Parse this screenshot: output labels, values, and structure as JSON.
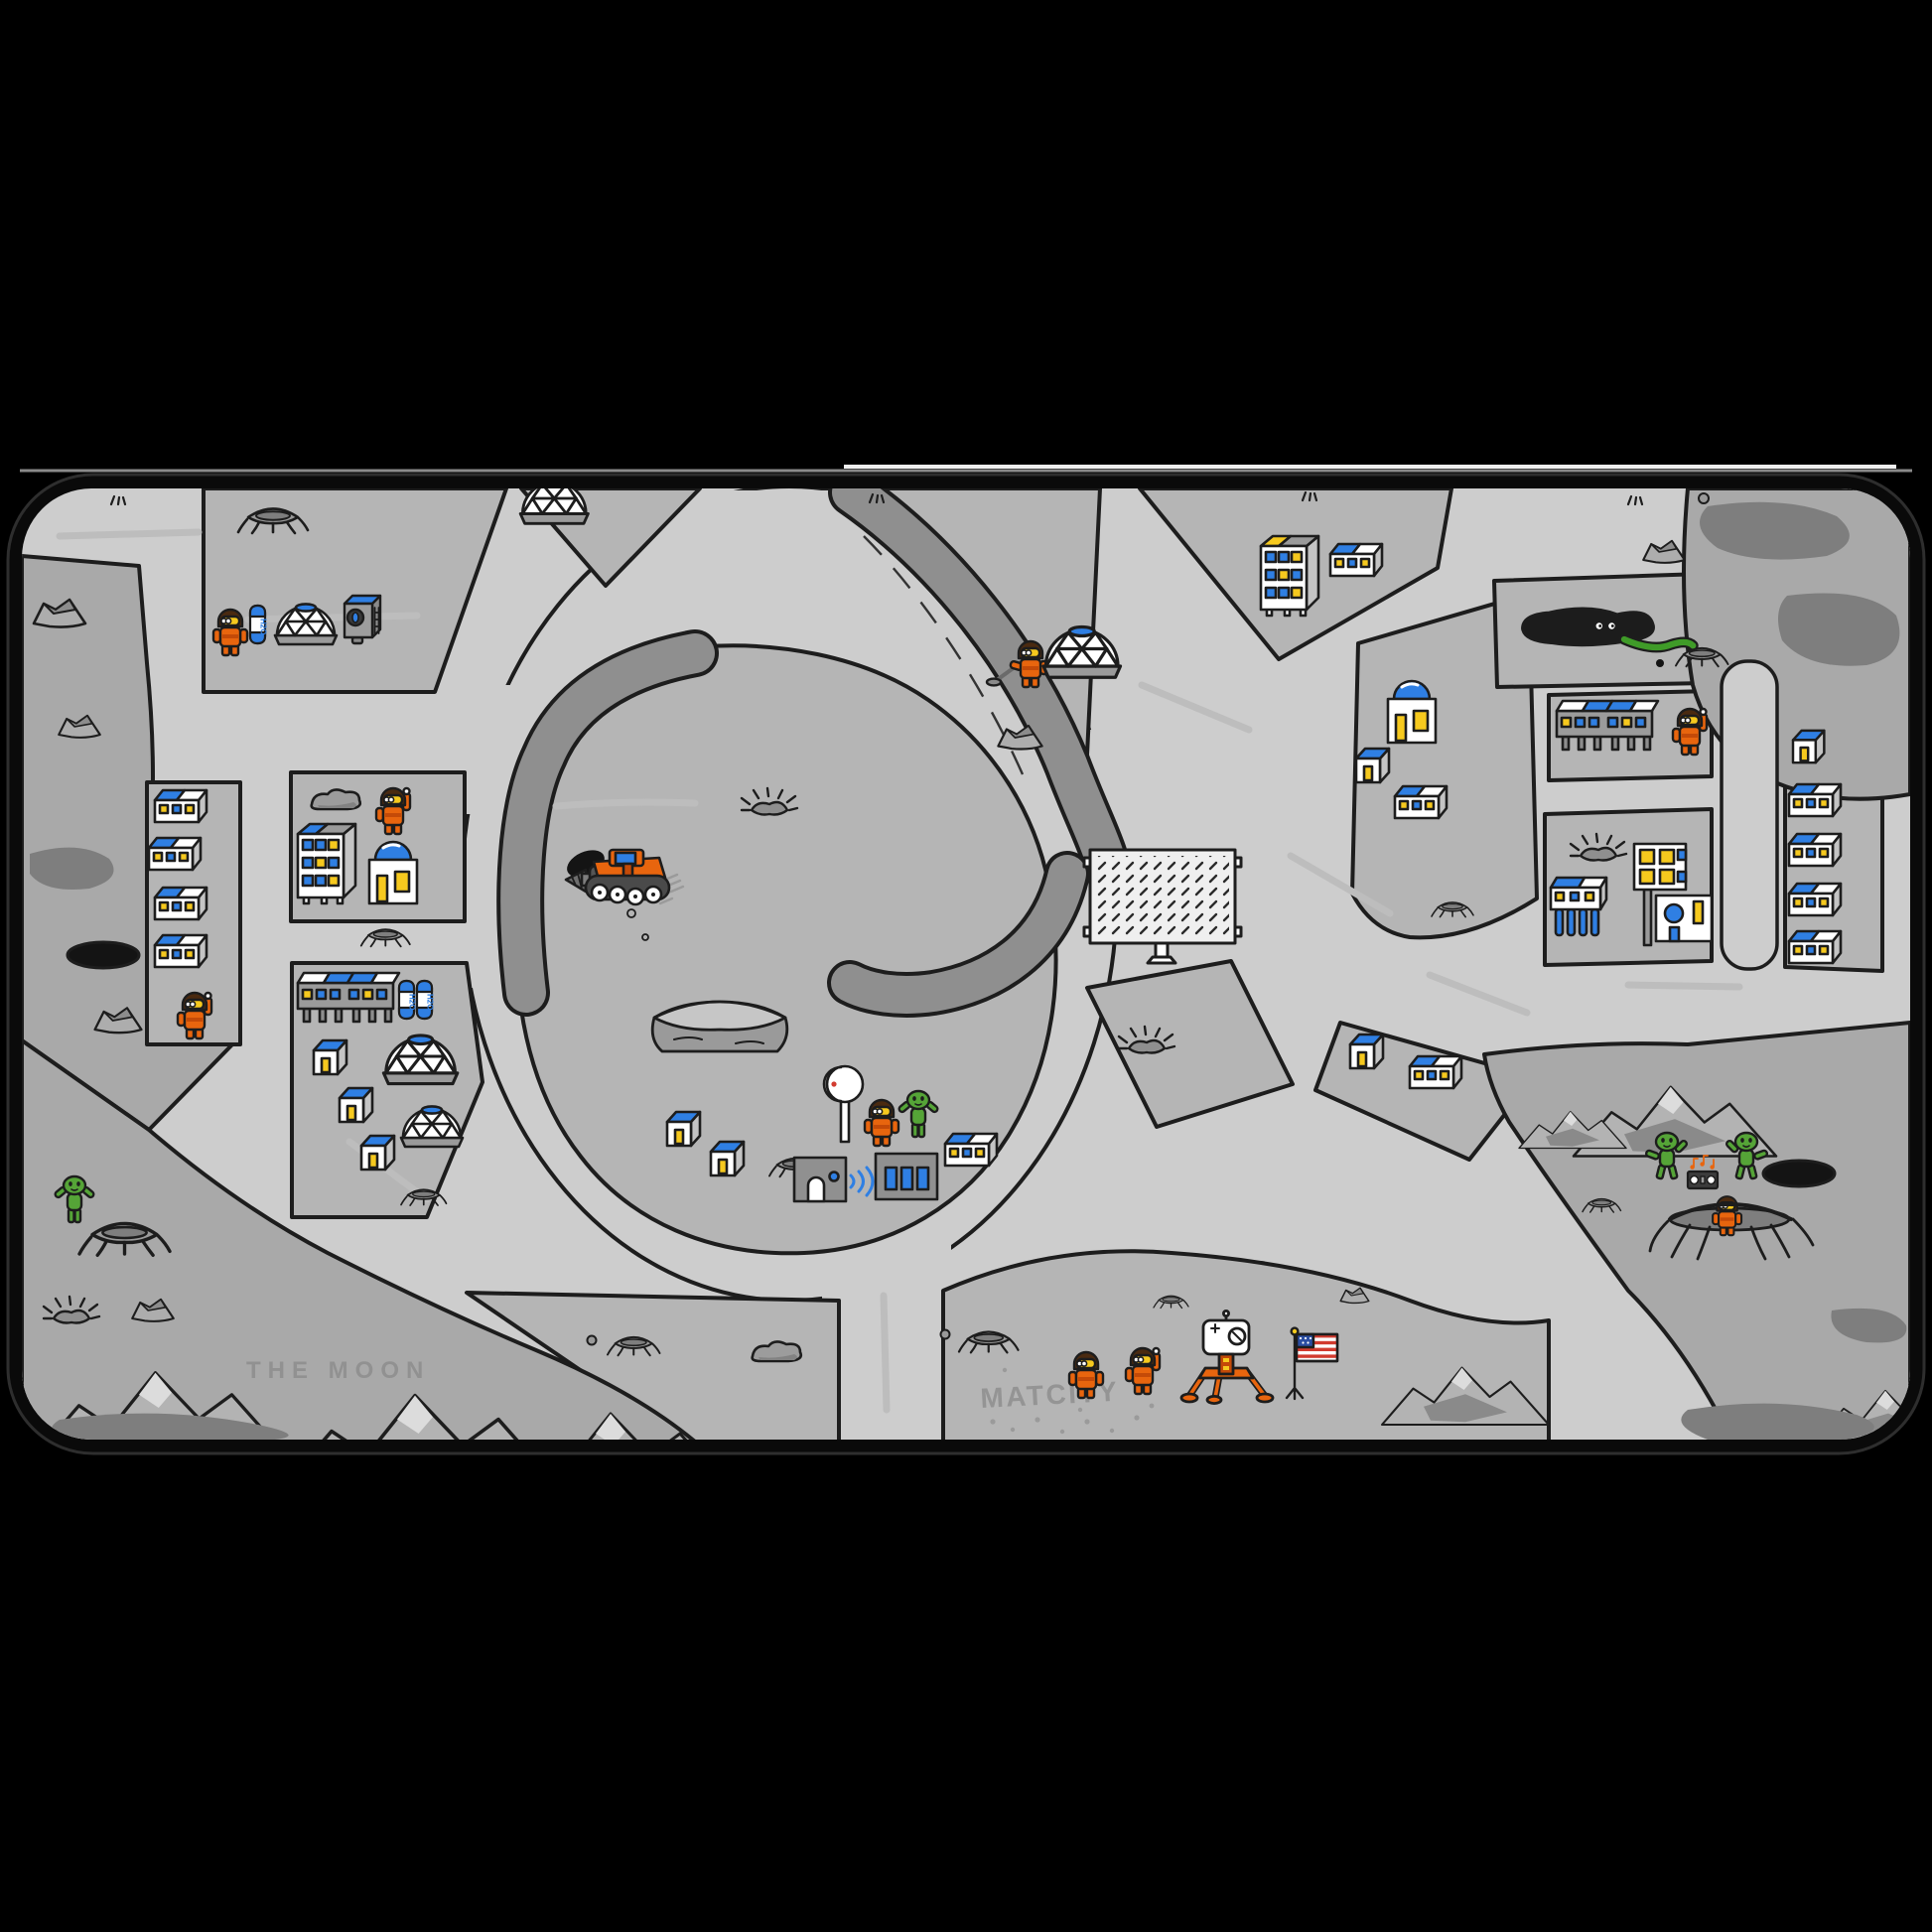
{
  "meta": {
    "description": "Product image of a moon-themed city play desk mat on a black backdrop",
    "surface": "THE MOON play mat with roads, craters, moon base buildings, astronauts and aliens"
  },
  "labels": {
    "region_name": "THE MOON",
    "city_name": "MATCITY",
    "tank_label": "H2O"
  },
  "colors": {
    "backdrop": "#000000",
    "mat_border": "#0a0a0a",
    "road": "#cdcdcd",
    "terrain": "#b5b5b5",
    "rocky_terrain": "#a9a9a9",
    "canyon": "#8f8f8f",
    "dark_patch": "#7e7e7e",
    "outline": "#1d1d1d",
    "accent_orange": "#e8650e",
    "accent_orange_dark": "#c44a08",
    "accent_blue": "#2f7fe3",
    "accent_yellow": "#f6c91e",
    "alien_green": "#55a437",
    "hole_black": "#141414",
    "flag_red": "#d23b2f",
    "flag_navy": "#2b4ea2",
    "white": "#ffffff"
  },
  "inventory": {
    "astronauts": 9,
    "aliens": 4,
    "geodesic_domes": 5,
    "observatory_buildings": 2,
    "apartment_buildings": 2,
    "houses": 8,
    "barracks_buildings": 12,
    "stilt_buildings": 3,
    "water_tanks": 3,
    "drill_vehicles": 1,
    "lunar_landers": 1,
    "us_flags": 1,
    "solar_panels": 1,
    "satellite_dishes": 1,
    "factories": 1,
    "space_snakes": 1,
    "boomboxes": 1
  },
  "zones": [
    {
      "name": "northwest-base",
      "features": [
        "astronaut",
        "H2O tank",
        "geodesic dome",
        "air machine",
        "craters"
      ]
    },
    {
      "name": "north-dome-island",
      "features": [
        "geodesic dome"
      ]
    },
    {
      "name": "central-crater-ring",
      "features": [
        "drill vehicle",
        "mesa",
        "satellite dish",
        "factory",
        "houses",
        "astronaut",
        "alien",
        "canyon rims"
      ]
    },
    {
      "name": "northeast-block",
      "features": [
        "apartment building",
        "barracks"
      ]
    },
    {
      "name": "east-observatory-block",
      "features": [
        "observatory",
        "house",
        "barracks",
        "geodesic dome",
        "crater"
      ]
    },
    {
      "name": "east-stilt-block",
      "features": [
        "stilt building",
        "astronaut"
      ]
    },
    {
      "name": "east-lab-block",
      "features": [
        "lab building",
        "stilt building",
        "crater"
      ]
    },
    {
      "name": "east-row-block",
      "features": [
        "house",
        "four barracks"
      ]
    },
    {
      "name": "west-apartment-block",
      "features": [
        "apartment building",
        "observatory",
        "waving astronaut",
        "rock"
      ]
    },
    {
      "name": "west-dome-block",
      "features": [
        "stilt building",
        "two H2O tanks",
        "three houses",
        "two geodesic domes",
        "crater"
      ]
    },
    {
      "name": "west-barracks-column",
      "features": [
        "four barracks",
        "astronaut"
      ]
    },
    {
      "name": "moon-south-plain",
      "features": [
        "THE MOON inscription",
        "alien",
        "craters",
        "mountains"
      ]
    },
    {
      "name": "matcity-landing-site",
      "features": [
        "MATCITY inscription",
        "two astronauts",
        "lunar lander",
        "US flag",
        "mountains"
      ]
    },
    {
      "name": "southeast-badlands",
      "features": [
        "two dancing aliens",
        "boombox",
        "crater with astronaut",
        "black hole",
        "mountains"
      ]
    },
    {
      "name": "northeast-badlands",
      "features": [
        "space snake",
        "rocks",
        "craters",
        "dark patches"
      ]
    }
  ]
}
